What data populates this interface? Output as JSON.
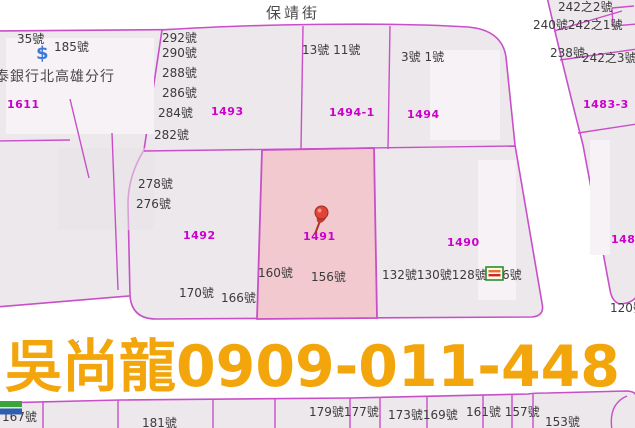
{
  "street": {
    "name": "保靖街"
  },
  "bank": {
    "name": "泰銀行北高雄分行",
    "dollar": "$"
  },
  "watermark": {
    "text": "吳尚龍0909-011-448"
  },
  "colors": {
    "line": "#C94FC9",
    "parcel_fill": "#EDE8EC",
    "building_light": "#F6F2F5",
    "building_dark": "#E7E1E6",
    "highlight_fill": "#F2C9CE",
    "parcel_label": "#CC00CC",
    "house_label": "#3A3A3A",
    "watermark": "#F3A60C",
    "dollar_blue": "#3C79D9",
    "pin_red": "#E04438",
    "store_green": "#2E8B2E",
    "famima_green": "#3AA53A",
    "famima_blue": "#2B5FB0"
  },
  "markers": {
    "pin": "pushpin-marker on parcel 1491",
    "cross": "✕",
    "store": "convenience-store-icon near 126號",
    "famima": "convenience-store-icon near 167號"
  },
  "parcel_labels": [
    {
      "id": "1611",
      "x": 7,
      "y": 99
    },
    {
      "id": "1493",
      "x": 211,
      "y": 106
    },
    {
      "id": "1494-1",
      "x": 329,
      "y": 107
    },
    {
      "id": "1494",
      "x": 407,
      "y": 109
    },
    {
      "id": "1483-3",
      "x": 583,
      "y": 99
    },
    {
      "id": "1492",
      "x": 183,
      "y": 230
    },
    {
      "id": "1491",
      "x": 303,
      "y": 231
    },
    {
      "id": "1490",
      "x": 447,
      "y": 237
    },
    {
      "id": "1484",
      "x": 611,
      "y": 234
    }
  ],
  "house_numbers": [
    {
      "text": "35號",
      "x": 17,
      "y": 33
    },
    {
      "text": "185號",
      "x": 54,
      "y": 41
    },
    {
      "text": "292號",
      "x": 162,
      "y": 32
    },
    {
      "text": "290號",
      "x": 162,
      "y": 47
    },
    {
      "text": "288號",
      "x": 162,
      "y": 67
    },
    {
      "text": "286號",
      "x": 162,
      "y": 87
    },
    {
      "text": "284號",
      "x": 158,
      "y": 107
    },
    {
      "text": "282號",
      "x": 154,
      "y": 129
    },
    {
      "text": "278號",
      "x": 138,
      "y": 178
    },
    {
      "text": "276號",
      "x": 136,
      "y": 198
    },
    {
      "text": "13號 11號",
      "x": 302,
      "y": 44
    },
    {
      "text": "3號 1號",
      "x": 401,
      "y": 51
    },
    {
      "text": "242之2號",
      "x": 558,
      "y": 1
    },
    {
      "text": "240號242之1號",
      "x": 533,
      "y": 19
    },
    {
      "text": "238號",
      "x": 550,
      "y": 47
    },
    {
      "text": "242之3號",
      "x": 582,
      "y": 52
    },
    {
      "text": "160號",
      "x": 258,
      "y": 267
    },
    {
      "text": "156號",
      "x": 311,
      "y": 271
    },
    {
      "text": "170號",
      "x": 179,
      "y": 287
    },
    {
      "text": "166號",
      "x": 221,
      "y": 292
    },
    {
      "text": "132號130號128號126號",
      "x": 382,
      "y": 269
    },
    {
      "text": "120號",
      "x": 610,
      "y": 302
    },
    {
      "text": "167號",
      "x": 2,
      "y": 411
    },
    {
      "text": "181號",
      "x": 142,
      "y": 417
    },
    {
      "text": "179號177號",
      "x": 309,
      "y": 406
    },
    {
      "text": "173號169號",
      "x": 388,
      "y": 409
    },
    {
      "text": "161號 157號",
      "x": 466,
      "y": 406
    },
    {
      "text": "153號",
      "x": 545,
      "y": 416
    }
  ]
}
